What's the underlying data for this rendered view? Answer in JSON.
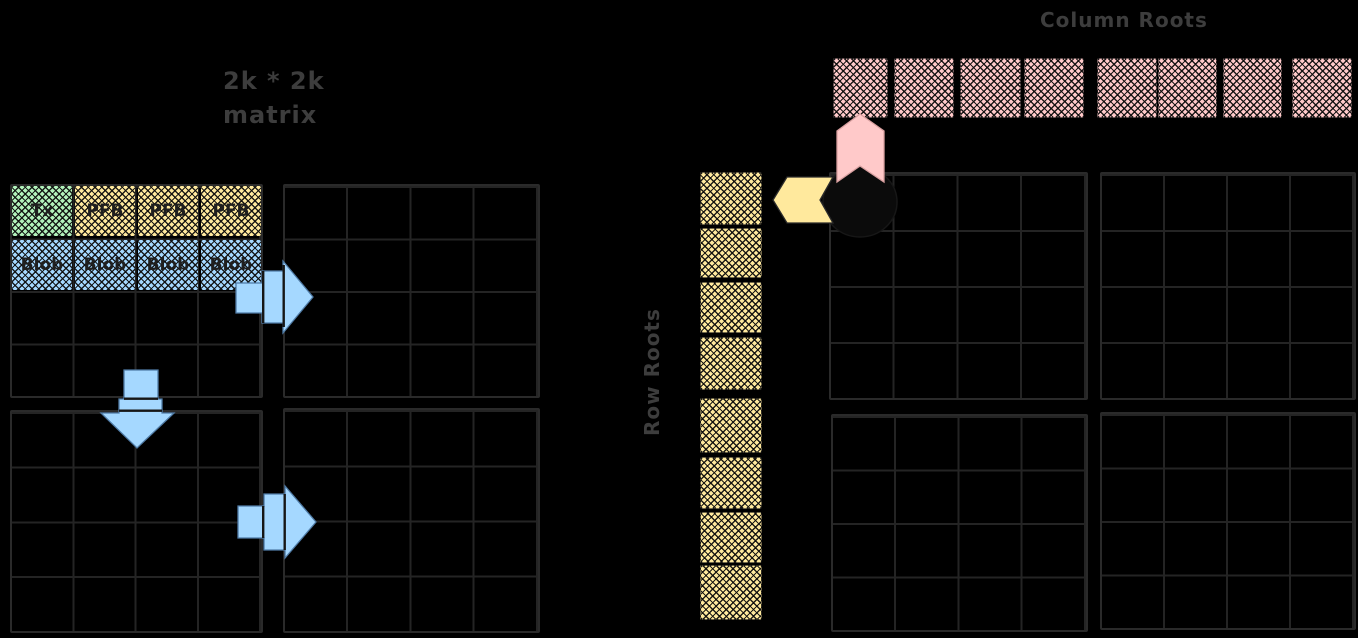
{
  "diagram": {
    "background": "#000000",
    "left_matrix": {
      "note_line1": "2k * 2k",
      "note_line2": "matrix",
      "header_cells": [
        "Tx",
        "PFB",
        "PFB",
        "PFB"
      ],
      "blob_cells": [
        "Blob",
        "Blob",
        "Blob",
        "Blob"
      ],
      "quadrants": "2x2",
      "cells_per_quadrant": "4x4",
      "arrows": [
        "extend-right-top",
        "extend-down",
        "extend-right-bottom"
      ]
    },
    "right_matrix": {
      "column_roots_label": "Column Roots",
      "row_roots_label": "Row Roots",
      "column_roots_count": 8,
      "row_roots_count": 8,
      "quadrants": "2x2",
      "cells_per_quadrant": "4x4"
    },
    "colors": {
      "tx_green": "#b2f2bb",
      "pfb_yellow": "#ffe99d",
      "blob_blue": "#a5d8ff",
      "root_pink": "#ffc9c9",
      "root_yellow": "#ffe99d",
      "arrow_blue": "#a5d8ff",
      "grid_line": "#242424",
      "text_dark": "#3d3d3d"
    }
  }
}
